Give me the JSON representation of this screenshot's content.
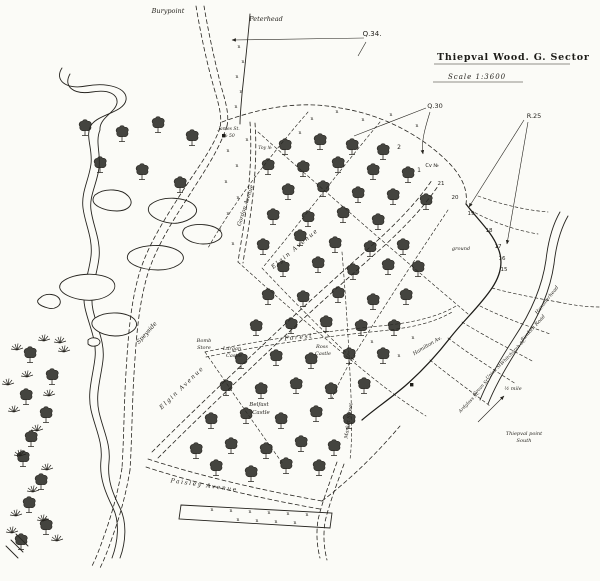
{
  "map": {
    "title": {
      "main": "Thiepval Wood. G. Sector",
      "scale_note": "Scale 1:3600"
    },
    "colors": {
      "ink": "#26241f",
      "paper": "#fbfbf7"
    },
    "labels": [
      {
        "t": "Burypoint",
        "x": 168,
        "y": 13,
        "r": 0,
        "s": 6.5
      },
      {
        "t": "Peterhead",
        "x": 266,
        "y": 21,
        "r": 0,
        "s": 6.5
      },
      {
        "t": "Q.34.",
        "x": 372,
        "y": 36,
        "r": 0,
        "s": 7,
        "c": "p"
      },
      {
        "t": "Q.30",
        "x": 435,
        "y": 108,
        "r": 0,
        "s": 6.5,
        "c": "p"
      },
      {
        "t": "R.25",
        "x": 534,
        "y": 118,
        "r": 0,
        "s": 6.5,
        "c": "p"
      },
      {
        "t": "Cv №",
        "x": 432,
        "y": 167,
        "r": 0,
        "s": 5,
        "c": "p"
      },
      {
        "t": "2",
        "x": 399,
        "y": 149,
        "r": 0,
        "s": 6,
        "c": "p"
      },
      {
        "t": "1",
        "x": 419,
        "y": 172,
        "r": 0,
        "s": 6,
        "c": "p"
      },
      {
        "t": "21",
        "x": 441,
        "y": 185,
        "r": 0,
        "s": 5.5,
        "c": "p"
      },
      {
        "t": "20",
        "x": 455,
        "y": 199,
        "r": 0,
        "s": 5.5,
        "c": "p"
      },
      {
        "t": "19",
        "x": 471,
        "y": 215,
        "r": 0,
        "s": 5.5,
        "c": "p"
      },
      {
        "t": "18",
        "x": 489,
        "y": 232,
        "r": 0,
        "s": 5.5,
        "c": "p"
      },
      {
        "t": "17",
        "x": 498,
        "y": 248,
        "r": 0,
        "s": 5.5,
        "c": "p"
      },
      {
        "t": "16",
        "x": 502,
        "y": 260,
        "r": 0,
        "s": 5.5,
        "c": "p"
      },
      {
        "t": "15",
        "x": 504,
        "y": 271,
        "r": 0,
        "s": 5.5,
        "c": "p"
      },
      {
        "t": "ground",
        "x": 461,
        "y": 250,
        "r": 0,
        "s": 5
      },
      {
        "t": "James St.",
        "x": 229,
        "y": 130,
        "r": 0,
        "s": 4.5
      },
      {
        "t": "№ 50",
        "x": 229,
        "y": 137,
        "r": 0,
        "s": 4.5
      },
      {
        "t": "Toy №",
        "x": 265,
        "y": 149,
        "r": 0,
        "s": 4.5
      },
      {
        "t": "Gordon Avenue",
        "x": 247,
        "y": 206,
        "r": -72,
        "s": 5.5
      },
      {
        "t": "Elgin Avenue",
        "x": 296,
        "y": 250,
        "r": -40,
        "s": 6,
        "c": "sp"
      },
      {
        "t": "Elgin Avenue",
        "x": 183,
        "y": 389,
        "r": -44,
        "s": 6,
        "c": "sp"
      },
      {
        "t": "Speyside",
        "x": 148,
        "y": 334,
        "r": -48,
        "s": 6
      },
      {
        "t": "Bomb",
        "x": 204,
        "y": 342,
        "r": 0,
        "s": 5
      },
      {
        "t": "Store",
        "x": 204,
        "y": 349,
        "r": 0,
        "s": 5
      },
      {
        "t": "Forest",
        "x": 299,
        "y": 339,
        "r": -6,
        "s": 6,
        "c": "sp"
      },
      {
        "t": "Lurgan",
        "x": 232,
        "y": 350,
        "r": 0,
        "s": 5
      },
      {
        "t": "Castle",
        "x": 234,
        "y": 357,
        "r": 0,
        "s": 5
      },
      {
        "t": "Ross",
        "x": 322,
        "y": 348,
        "r": 0,
        "s": 5
      },
      {
        "t": "Castle",
        "x": 323,
        "y": 355,
        "r": 0,
        "s": 5
      },
      {
        "t": "Belfast",
        "x": 259,
        "y": 406,
        "r": 0,
        "s": 5.5
      },
      {
        "t": "Castle",
        "x": 261,
        "y": 414,
        "r": 0,
        "s": 5.5
      },
      {
        "t": "Market Street",
        "x": 350,
        "y": 421,
        "r": -82,
        "s": 5
      },
      {
        "t": "Paisley Avenue",
        "x": 204,
        "y": 487,
        "r": 8,
        "s": 6,
        "c": "sp"
      },
      {
        "t": "Hammerhead",
        "x": 548,
        "y": 301,
        "r": -52,
        "s": 5
      },
      {
        "t": "Sunken Road",
        "x": 534,
        "y": 329,
        "r": -48,
        "s": 5
      },
      {
        "t": "Whitchurch St.",
        "x": 514,
        "y": 353,
        "r": -46,
        "s": 4.5
      },
      {
        "t": "Union St.",
        "x": 495,
        "y": 372,
        "r": -46,
        "s": 4.5
      },
      {
        "t": "Govan St.",
        "x": 482,
        "y": 388,
        "r": -46,
        "s": 4.5
      },
      {
        "t": "Ardglass St.",
        "x": 470,
        "y": 403,
        "r": -46,
        "s": 4.5
      },
      {
        "t": "Hamilton Av.",
        "x": 428,
        "y": 347,
        "r": -31,
        "s": 5
      },
      {
        "t": "½ mile",
        "x": 513,
        "y": 390,
        "r": 0,
        "s": 5
      },
      {
        "t": "Thiepval point",
        "x": 524,
        "y": 435,
        "r": 0,
        "s": 5
      },
      {
        "t": "South",
        "x": 524,
        "y": 442,
        "r": 0,
        "s": 5
      }
    ],
    "trees": [
      [
        85,
        133
      ],
      [
        122,
        139
      ],
      [
        158,
        130
      ],
      [
        192,
        143
      ],
      [
        100,
        170
      ],
      [
        142,
        177
      ],
      [
        180,
        190
      ],
      [
        285,
        152
      ],
      [
        320,
        147
      ],
      [
        352,
        152
      ],
      [
        383,
        157
      ],
      [
        268,
        172
      ],
      [
        303,
        174
      ],
      [
        338,
        170
      ],
      [
        373,
        177
      ],
      [
        408,
        180
      ],
      [
        288,
        197
      ],
      [
        323,
        194
      ],
      [
        358,
        200
      ],
      [
        393,
        202
      ],
      [
        426,
        207
      ],
      [
        273,
        222
      ],
      [
        308,
        224
      ],
      [
        343,
        220
      ],
      [
        378,
        227
      ],
      [
        263,
        252
      ],
      [
        300,
        243
      ],
      [
        335,
        250
      ],
      [
        370,
        254
      ],
      [
        403,
        252
      ],
      [
        283,
        274
      ],
      [
        318,
        270
      ],
      [
        353,
        277
      ],
      [
        388,
        272
      ],
      [
        418,
        274
      ],
      [
        268,
        302
      ],
      [
        303,
        304
      ],
      [
        338,
        300
      ],
      [
        373,
        307
      ],
      [
        406,
        302
      ],
      [
        256,
        333
      ],
      [
        291,
        331
      ],
      [
        326,
        329
      ],
      [
        361,
        333
      ],
      [
        394,
        333
      ],
      [
        241,
        366
      ],
      [
        276,
        363
      ],
      [
        311,
        366
      ],
      [
        349,
        361
      ],
      [
        383,
        361
      ],
      [
        226,
        393
      ],
      [
        261,
        396
      ],
      [
        296,
        391
      ],
      [
        331,
        396
      ],
      [
        364,
        391
      ],
      [
        211,
        426
      ],
      [
        246,
        421
      ],
      [
        281,
        426
      ],
      [
        316,
        419
      ],
      [
        349,
        426
      ],
      [
        196,
        456
      ],
      [
        231,
        451
      ],
      [
        266,
        456
      ],
      [
        301,
        449
      ],
      [
        334,
        453
      ],
      [
        216,
        473
      ],
      [
        251,
        479
      ],
      [
        286,
        471
      ],
      [
        319,
        473
      ],
      [
        30,
        360
      ],
      [
        52,
        382
      ],
      [
        26,
        402
      ],
      [
        46,
        420
      ],
      [
        31,
        444
      ],
      [
        23,
        464
      ],
      [
        41,
        487
      ],
      [
        29,
        510
      ],
      [
        46,
        532
      ],
      [
        21,
        547
      ]
    ],
    "tufts": [
      [
        17,
        350
      ],
      [
        44,
        341
      ],
      [
        60,
        343
      ],
      [
        27,
        377
      ],
      [
        49,
        396
      ],
      [
        14,
        412
      ],
      [
        37,
        431
      ],
      [
        20,
        456
      ],
      [
        47,
        470
      ],
      [
        33,
        492
      ],
      [
        16,
        516
      ],
      [
        43,
        521
      ],
      [
        57,
        541
      ],
      [
        12,
        533
      ],
      [
        64,
        352
      ],
      [
        8,
        385
      ]
    ],
    "shelter_marks": [
      [
        239,
        48
      ],
      [
        243,
        63
      ],
      [
        237,
        78
      ],
      [
        241,
        93
      ],
      [
        236,
        108
      ],
      [
        247,
        141
      ],
      [
        228,
        152
      ],
      [
        237,
        167
      ],
      [
        226,
        183
      ],
      [
        238,
        199
      ],
      [
        228,
        215
      ],
      [
        220,
        231
      ],
      [
        233,
        245
      ],
      [
        300,
        134
      ],
      [
        312,
        120
      ],
      [
        337,
        113
      ],
      [
        363,
        121
      ],
      [
        391,
        116
      ],
      [
        417,
        127
      ],
      [
        372,
        343
      ],
      [
        399,
        357
      ],
      [
        413,
        339
      ],
      [
        212,
        511
      ],
      [
        231,
        512
      ],
      [
        250,
        513
      ],
      [
        269,
        514
      ],
      [
        288,
        515
      ],
      [
        307,
        516
      ],
      [
        238,
        521
      ],
      [
        257,
        522
      ],
      [
        276,
        523
      ],
      [
        295,
        524
      ]
    ],
    "squares": [
      [
        410,
        383
      ],
      [
        222,
        134
      ]
    ]
  }
}
